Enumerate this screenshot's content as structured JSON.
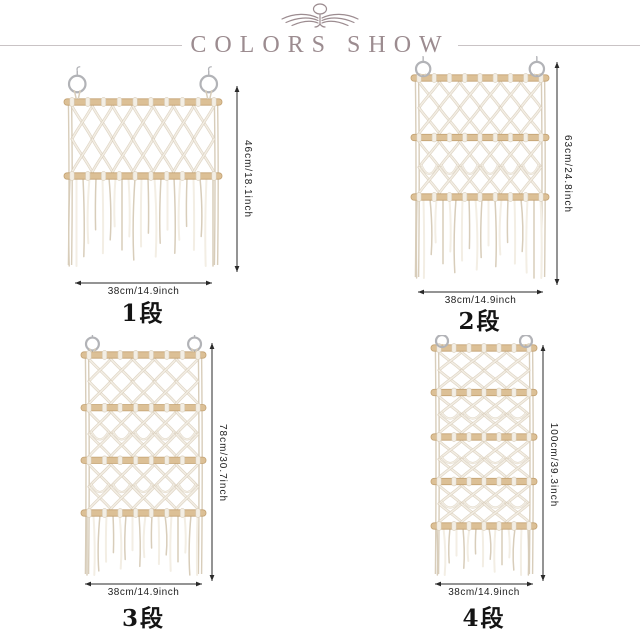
{
  "header": {
    "title": "COLORS SHOW",
    "ornament_icon": "winged-crest-flourish-icon"
  },
  "products": [
    {
      "name": "1-tier macrame wall hanging",
      "tier_label": "1段",
      "tiers": 1,
      "dowels": 2,
      "height_label": "46cm/18.1inch",
      "width_label": "38cm/14.9inch"
    },
    {
      "name": "2-tier macrame wall hanging",
      "tier_label": "2段",
      "tiers": 2,
      "dowels": 3,
      "height_label": "63cm/24.8inch",
      "width_label": "38cm/14.9inch"
    },
    {
      "name": "3-tier macrame wall hanging",
      "tier_label": "3段",
      "tiers": 3,
      "dowels": 4,
      "height_label": "78cm/30.7inch",
      "width_label": "38cm/14.9inch"
    },
    {
      "name": "4-tier macrame wall hanging",
      "tier_label": "4段",
      "tiers": 4,
      "dowels": 5,
      "height_label": "38cm/14.9inch — width; height 100cm/39.3inch",
      "width_label": "38cm/14.9inch"
    }
  ],
  "labels": {
    "p1_height": "46cm/18.1inch",
    "p2_height": "63cm/24.8inch",
    "p3_height": "78cm/30.7inch",
    "p4_height": "100cm/39.3inch",
    "shared_width": "38cm/14.9inch"
  },
  "colors": {
    "accent": "#9c8c90",
    "rule": "#c9c3c5",
    "dim": "#2a2a2a",
    "wood": "#dcc096",
    "wood_edge": "#c3a273",
    "cord_dark": "#d8cdba",
    "cord_light": "#f3eee4",
    "ring": "#b2b3b7",
    "background": "#ffffff"
  }
}
